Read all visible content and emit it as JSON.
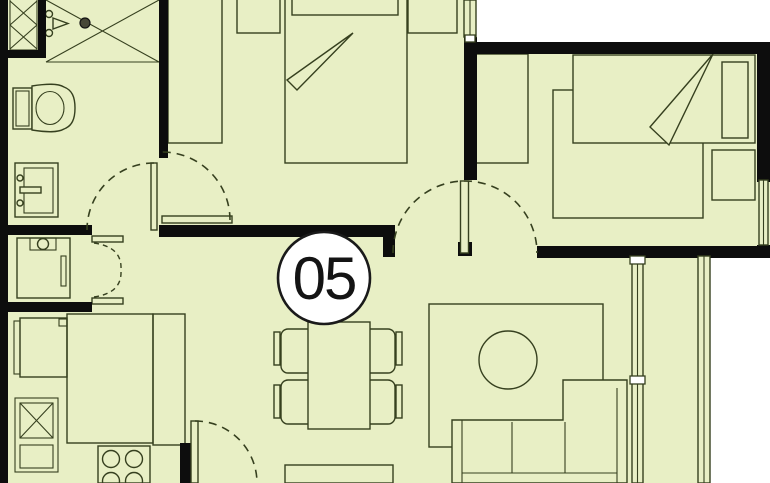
{
  "unit_badge": {
    "label": "05"
  },
  "colors": {
    "floor": "#e8efc5",
    "outside": "#ffffff",
    "wall": "#0d0d0d",
    "line": "#36401f",
    "badge-bg": "#ffffff",
    "badge-border": "#1a1a1a",
    "badge-text": "#141414"
  },
  "objects": [
    "duct-shaft",
    "shower",
    "shower-drain",
    "toilet",
    "vanity-sink",
    "laundry-bifold-door",
    "washing-machine",
    "refrigerator",
    "kitchen-counter",
    "storage-cabinet",
    "cooktop",
    "wardrobe",
    "double-bed",
    "nightstand",
    "single-bed",
    "desk",
    "dining-table",
    "dining-chair",
    "rug",
    "coffee-table",
    "sofa",
    "tv-cabinet",
    "sliding-door",
    "balcony-railing",
    "window",
    "door-swing"
  ]
}
